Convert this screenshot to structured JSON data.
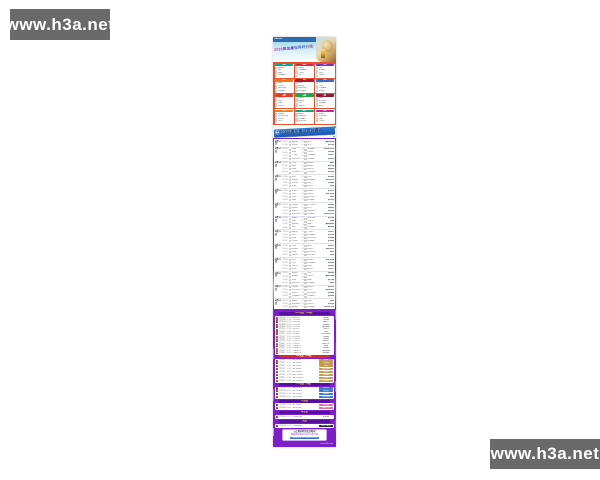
{
  "watermarks": {
    "top_left": "www.h3a.net",
    "bottom_right": "www.h3a.net"
  },
  "poster": {
    "brand": "h3a.net",
    "groups_title": "2026美加墨世界杯分组",
    "schedule_banner": "2026美加墨世界杯赛程",
    "banner_icon": "⚽",
    "vs_label": "VS",
    "groups": [
      {
        "name": "A组",
        "color": "#00a7a0",
        "teams": [
          "墨西哥",
          "南非",
          "韩国",
          "附加赛D"
        ]
      },
      {
        "name": "B组",
        "color": "#d42b4c",
        "teams": [
          "加拿大",
          "附加赛A",
          "卡塔尔",
          "瑞士"
        ]
      },
      {
        "name": "C组",
        "color": "#7b2fbe",
        "teams": [
          "巴西",
          "摩洛哥",
          "海地",
          "苏格兰"
        ]
      },
      {
        "name": "D组",
        "color": "#f07818",
        "teams": [
          "美国",
          "巴拉圭",
          "澳大利亚",
          "附加赛C"
        ]
      },
      {
        "name": "E组",
        "color": "#b01830",
        "teams": [
          "德国",
          "库拉索",
          "科特迪瓦",
          "厄瓜多尔"
        ]
      },
      {
        "name": "F组",
        "color": "#2a6fd4",
        "teams": [
          "荷兰",
          "日本",
          "附加赛B",
          "突尼斯"
        ]
      },
      {
        "name": "G组",
        "color": "#e03c28",
        "teams": [
          "比利时",
          "埃及",
          "伊朗",
          "新西兰"
        ]
      },
      {
        "name": "H组",
        "color": "#2ba04a",
        "teams": [
          "西班牙",
          "佛得角",
          "沙特",
          "乌拉圭"
        ]
      },
      {
        "name": "I组",
        "color": "#8c1f2f",
        "teams": [
          "法国",
          "塞内加尔",
          "附加赛2",
          "挪威"
        ]
      },
      {
        "name": "J组",
        "color": "#ef7d1a",
        "teams": [
          "阿根廷",
          "阿尔及利亚",
          "奥地利",
          "约旦"
        ]
      },
      {
        "name": "K组",
        "color": "#0aa78f",
        "teams": [
          "葡萄牙",
          "乌兹别克",
          "附加赛1",
          "哥伦比亚"
        ]
      },
      {
        "name": "L组",
        "color": "#c2299e",
        "teams": [
          "英格兰",
          "克罗地亚",
          "加纳",
          "巴拿马"
        ]
      }
    ],
    "group_stage": [
      {
        "date": "6月12日",
        "matches": [
          {
            "time": "06:00",
            "home": "墨西哥",
            "away": "南非",
            "venue": "墨西哥城"
          },
          {
            "time": "09:00",
            "home": "加拿大",
            "away": "瑞士",
            "venue": "多伦多"
          }
        ]
      },
      {
        "date": "6月13日",
        "matches": [
          {
            "time": "02:00",
            "home": "韩国",
            "away": "附加赛D",
            "venue": "瓜达拉哈拉"
          },
          {
            "time": "05:00",
            "home": "美国",
            "away": "巴拉圭",
            "venue": "洛杉矶"
          },
          {
            "time": "07:00",
            "home": "卡塔尔",
            "away": "附加赛A",
            "venue": "温哥华"
          },
          {
            "time": "09:00",
            "home": "澳大利亚",
            "away": "附加赛C",
            "venue": "旧金山"
          }
        ]
      },
      {
        "date": "6月14日",
        "matches": [
          {
            "time": "02:00",
            "home": "巴西",
            "away": "摩洛哥",
            "venue": "纽约"
          },
          {
            "time": "05:00",
            "home": "海地",
            "away": "苏格兰",
            "venue": "波士顿"
          },
          {
            "time": "07:00",
            "home": "德国",
            "away": "库拉索",
            "venue": "休斯敦"
          },
          {
            "time": "09:00",
            "home": "科特迪瓦",
            "away": "厄瓜多尔",
            "venue": "达拉斯"
          }
        ]
      },
      {
        "date": "6月15日",
        "matches": [
          {
            "time": "02:00",
            "home": "荷兰",
            "away": "日本",
            "venue": "达拉斯"
          },
          {
            "time": "05:00",
            "home": "突尼斯",
            "away": "附加赛B",
            "venue": "亚特兰大"
          },
          {
            "time": "07:00",
            "home": "比利时",
            "away": "埃及",
            "venue": "西雅图"
          },
          {
            "time": "09:00",
            "home": "伊朗",
            "away": "新西兰",
            "venue": "费城"
          }
        ]
      },
      {
        "date": "6月16日",
        "matches": [
          {
            "time": "02:00",
            "home": "西班牙",
            "away": "佛得角",
            "venue": "迈阿密"
          },
          {
            "time": "05:00",
            "home": "沙特",
            "away": "乌拉圭",
            "venue": "堪萨斯城"
          },
          {
            "time": "07:00",
            "home": "法国",
            "away": "塞内加尔",
            "venue": "纽约"
          },
          {
            "time": "09:00",
            "home": "挪威",
            "away": "附加赛2",
            "venue": "多伦多"
          }
        ]
      },
      {
        "date": "6月17日",
        "matches": [
          {
            "time": "02:00",
            "home": "阿根廷",
            "away": "阿尔及利亚",
            "venue": "达拉斯"
          },
          {
            "time": "05:00",
            "home": "奥地利",
            "away": "约旦",
            "venue": "休斯敦"
          },
          {
            "time": "07:00",
            "home": "葡萄牙",
            "away": "乌兹别克",
            "venue": "洛杉矶"
          },
          {
            "time": "09:00",
            "home": "哥伦比亚",
            "away": "附加赛1",
            "venue": "瓜达拉哈拉"
          }
        ]
      },
      {
        "date": "6月18日",
        "matches": [
          {
            "time": "02:00",
            "home": "英格兰",
            "away": "克罗地亚",
            "venue": "波士顿"
          },
          {
            "time": "05:00",
            "home": "加纳",
            "away": "巴拿马",
            "venue": "费城"
          },
          {
            "time": "07:00",
            "home": "墨西哥",
            "away": "韩国",
            "venue": "墨西哥城"
          },
          {
            "time": "09:00",
            "home": "南非",
            "away": "附加赛D",
            "venue": "蒙特雷"
          }
        ]
      },
      {
        "date": "6月19日",
        "matches": [
          {
            "time": "02:00",
            "home": "加拿大",
            "away": "卡塔尔",
            "venue": "温哥华"
          },
          {
            "time": "05:00",
            "home": "瑞士",
            "away": "附加赛A",
            "venue": "多伦多"
          },
          {
            "time": "07:00",
            "home": "美国",
            "away": "澳大利亚",
            "venue": "西雅图"
          },
          {
            "time": "09:00",
            "home": "巴拉圭",
            "away": "附加赛C",
            "venue": "旧金山"
          }
        ]
      },
      {
        "date": "6月20日",
        "matches": [
          {
            "time": "02:00",
            "home": "巴西",
            "away": "海地",
            "venue": "迈阿密"
          },
          {
            "time": "05:00",
            "home": "摩洛哥",
            "away": "苏格兰",
            "venue": "亚特兰大"
          },
          {
            "time": "07:00",
            "home": "德国",
            "away": "科特迪瓦",
            "venue": "纽约"
          },
          {
            "time": "09:00",
            "home": "库拉索",
            "away": "厄瓜多尔",
            "venue": "费城"
          }
        ]
      },
      {
        "date": "6月21日",
        "matches": [
          {
            "time": "02:00",
            "home": "荷兰",
            "away": "突尼斯",
            "venue": "堪萨斯城"
          },
          {
            "time": "05:00",
            "home": "日本",
            "away": "附加赛B",
            "venue": "达拉斯"
          },
          {
            "time": "07:00",
            "home": "比利时",
            "away": "伊朗",
            "venue": "洛杉矶"
          },
          {
            "time": "09:00",
            "home": "埃及",
            "away": "新西兰",
            "venue": "温哥华"
          }
        ]
      },
      {
        "date": "6月22日",
        "matches": [
          {
            "time": "02:00",
            "home": "西班牙",
            "away": "沙特",
            "venue": "休斯敦"
          },
          {
            "time": "05:00",
            "home": "佛得角",
            "away": "乌拉圭",
            "venue": "墨西哥城"
          },
          {
            "time": "07:00",
            "home": "法国",
            "away": "挪威",
            "venue": "波士顿"
          },
          {
            "time": "09:00",
            "home": "塞内加尔",
            "away": "附加赛2",
            "venue": "纽约"
          }
        ]
      },
      {
        "date": "6月23日",
        "matches": [
          {
            "time": "02:00",
            "home": "阿根廷",
            "away": "奥地利",
            "venue": "迈阿密"
          },
          {
            "time": "05:00",
            "home": "阿尔及利亚",
            "away": "约旦",
            "venue": "亚特兰大"
          },
          {
            "time": "07:00",
            "home": "葡萄牙",
            "away": "哥伦比亚",
            "venue": "西雅图"
          },
          {
            "time": "09:00",
            "home": "乌兹别克",
            "away": "附加赛1",
            "venue": "旧金山"
          }
        ]
      },
      {
        "date": "6月24日",
        "matches": [
          {
            "time": "02:00",
            "home": "英格兰",
            "away": "加纳",
            "venue": "纽约"
          },
          {
            "time": "05:00",
            "home": "克罗地亚",
            "away": "巴拿马",
            "venue": "多伦多"
          },
          {
            "time": "07:00",
            "home": "墨西哥",
            "away": "附加赛D",
            "venue": "瓜达拉哈拉"
          },
          {
            "time": "09:00",
            "home": "韩国",
            "away": "南非",
            "venue": "蒙特雷"
          }
        ]
      }
    ],
    "knockout": {
      "r32": {
        "title": "1/16决赛（32强）",
        "rows": [
          {
            "no": "1",
            "date": "6月29日",
            "time": "03:00",
            "match": "A1 vs C2",
            "venue": "洛杉矶"
          },
          {
            "no": "2",
            "date": "6月29日",
            "time": "07:00",
            "match": "C1 vs F2",
            "venue": "达拉斯"
          },
          {
            "no": "3",
            "date": "6月30日",
            "time": "02:00",
            "match": "B1 vs E2",
            "venue": "温哥华"
          },
          {
            "no": "4",
            "date": "6月30日",
            "time": "05:00",
            "match": "D1 vs B2",
            "venue": "西雅图"
          },
          {
            "no": "5",
            "date": "6月30日",
            "time": "08:00",
            "match": "F1 vs H2",
            "venue": "墨西哥城"
          },
          {
            "no": "6",
            "date": "7月1日",
            "time": "02:00",
            "match": "E1 vs I2",
            "venue": "多伦多"
          },
          {
            "no": "7",
            "date": "7月1日",
            "time": "05:00",
            "match": "G1 vs J2",
            "venue": "纽约"
          },
          {
            "no": "8",
            "date": "7月1日",
            "time": "08:00",
            "match": "I1 vs A2",
            "venue": "瓜达拉哈拉"
          },
          {
            "no": "9",
            "date": "7月2日",
            "time": "02:00",
            "match": "H1 vs K2",
            "venue": "休斯敦"
          },
          {
            "no": "10",
            "date": "7月2日",
            "time": "05:00",
            "match": "J1 vs G2",
            "venue": "波士顿"
          },
          {
            "no": "11",
            "date": "7月2日",
            "time": "08:00",
            "match": "K1 vs L2",
            "venue": "旧金山"
          },
          {
            "no": "12",
            "date": "7月3日",
            "time": "02:00",
            "match": "L1 vs D2",
            "venue": "亚特兰大"
          },
          {
            "no": "13",
            "date": "7月3日",
            "time": "05:00",
            "match": "小组第三1",
            "venue": "费城"
          },
          {
            "no": "14",
            "date": "7月3日",
            "time": "08:00",
            "match": "小组第三2",
            "venue": "迈阿密"
          },
          {
            "no": "15",
            "date": "7月4日",
            "time": "02:00",
            "match": "小组第三3",
            "venue": "堪萨斯城"
          },
          {
            "no": "16",
            "date": "7月4日",
            "time": "05:00",
            "match": "小组第三4",
            "venue": "蒙特雷"
          }
        ]
      },
      "r16": {
        "title": "1/8决赛（16强）",
        "rows": [
          {
            "no": "1",
            "date": "7月5日",
            "time": "03:00",
            "match": "胜1 vs 胜2",
            "venue": "费城"
          },
          {
            "no": "2",
            "date": "7月5日",
            "time": "07:00",
            "match": "胜3 vs 胜4",
            "venue": "休斯敦"
          },
          {
            "no": "3",
            "date": "7月6日",
            "time": "03:00",
            "match": "胜5 vs 胜6",
            "venue": "纽约"
          },
          {
            "no": "4",
            "date": "7月6日",
            "time": "07:00",
            "match": "胜7 vs 胜8",
            "venue": "墨西哥城"
          },
          {
            "no": "5",
            "date": "7月7日",
            "time": "03:00",
            "match": "胜9 vs 胜10",
            "venue": "达拉斯"
          },
          {
            "no": "6",
            "date": "7月7日",
            "time": "07:00",
            "match": "胜11 vs 胜12",
            "venue": "西雅图"
          },
          {
            "no": "7",
            "date": "7月8日",
            "time": "03:00",
            "match": "胜13 vs 胜14",
            "venue": "洛杉矶"
          },
          {
            "no": "8",
            "date": "7月8日",
            "time": "07:00",
            "match": "胜15 vs 胜16",
            "venue": "迈阿密"
          }
        ]
      },
      "qf": {
        "title": "1/4决赛（8强）",
        "rows": [
          {
            "no": "1",
            "date": "7月10日",
            "time": "03:00",
            "match": "胜A vs 胜B",
            "venue": "波士顿"
          },
          {
            "no": "2",
            "date": "7月10日",
            "time": "08:00",
            "match": "胜C vs 胜D",
            "venue": "洛杉矶"
          },
          {
            "no": "3",
            "date": "7月11日",
            "time": "03:00",
            "match": "胜E vs 胜F",
            "venue": "迈阿密"
          },
          {
            "no": "4",
            "date": "7月11日",
            "time": "08:00",
            "match": "胜G vs 胜H",
            "venue": "堪萨斯城"
          }
        ]
      },
      "sf": {
        "title": "半决赛",
        "rows": [
          {
            "no": "1",
            "date": "7月15日",
            "time": "03:00",
            "match": "胜1 vs 胜2",
            "venue": "达拉斯"
          },
          {
            "no": "2",
            "date": "7月16日",
            "time": "03:00",
            "match": "胜3 vs 胜4",
            "venue": "亚特兰大"
          }
        ]
      },
      "third": {
        "title": "季军赛",
        "rows": [
          {
            "no": "1",
            "date": "7月19日",
            "time": "03:00",
            "match": "半决赛负者",
            "venue": "迈阿密"
          }
        ]
      },
      "final": {
        "title": "决赛",
        "rows": [
          {
            "no": "1",
            "date": "7月20日",
            "time": "03:00",
            "match": "半决赛胜者",
            "venue": "纽约大都会"
          }
        ]
      }
    },
    "notes": [
      "以上时间均为北京时间",
      "赛程如有变动以官方公布为准",
      "更多赛程请访问 www.h3a.net"
    ],
    "poster_watermark": "www.h3a.net"
  }
}
